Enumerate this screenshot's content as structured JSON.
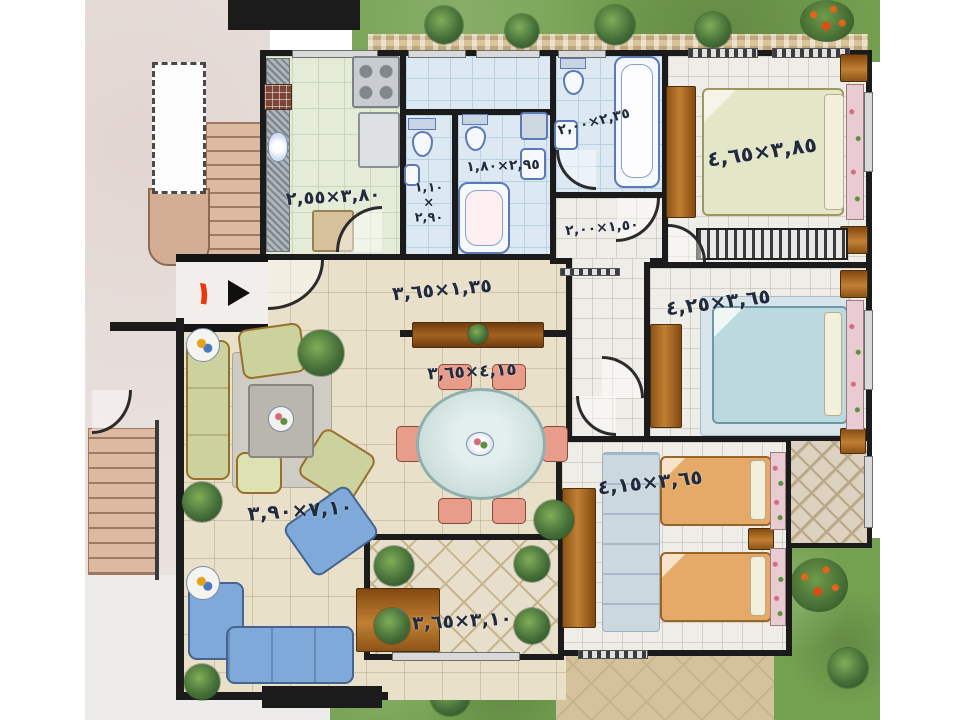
{
  "plan": {
    "name": "apartment-floor-plan",
    "entrance": {
      "number": "١"
    },
    "rooms": {
      "kitchen": {
        "dim": "٣,٨٠×٢,٥٥"
      },
      "wc": {
        "dim_w": "١,١٠",
        "times": "×",
        "dim_l": "٢,٩٠"
      },
      "bathroom": {
        "dim": "٢,٩٥×١,٨٠"
      },
      "master_bath": {
        "dim": "٢,٣٥×٢,٠٠"
      },
      "corridor": {
        "dim": "١,٥٠×٢,٠٠"
      },
      "master_bedroom": {
        "dim": "٣,٨٥×٤,٦٥"
      },
      "bedroom2": {
        "dim": "٣,٦٥×٤,٢٥"
      },
      "bedroom3": {
        "dim": "٣,٦٥×٤,١٥"
      },
      "hall": {
        "dim": "١,٣٥×٣,٦٥"
      },
      "dining": {
        "dim": "٤,١٥×٣,٦٥"
      },
      "living": {
        "dim": "٧,١٠×٣,٩٠"
      },
      "terrace": {
        "dim": "٣,١٠×٣,٦٥"
      }
    },
    "colors": {
      "wall": "#1b1b1b",
      "grass": "#74a150",
      "stone": "#d9c399",
      "pavement": "#e8e1de",
      "ink": "#222b3d",
      "entrance_red": "#e8380d"
    }
  }
}
